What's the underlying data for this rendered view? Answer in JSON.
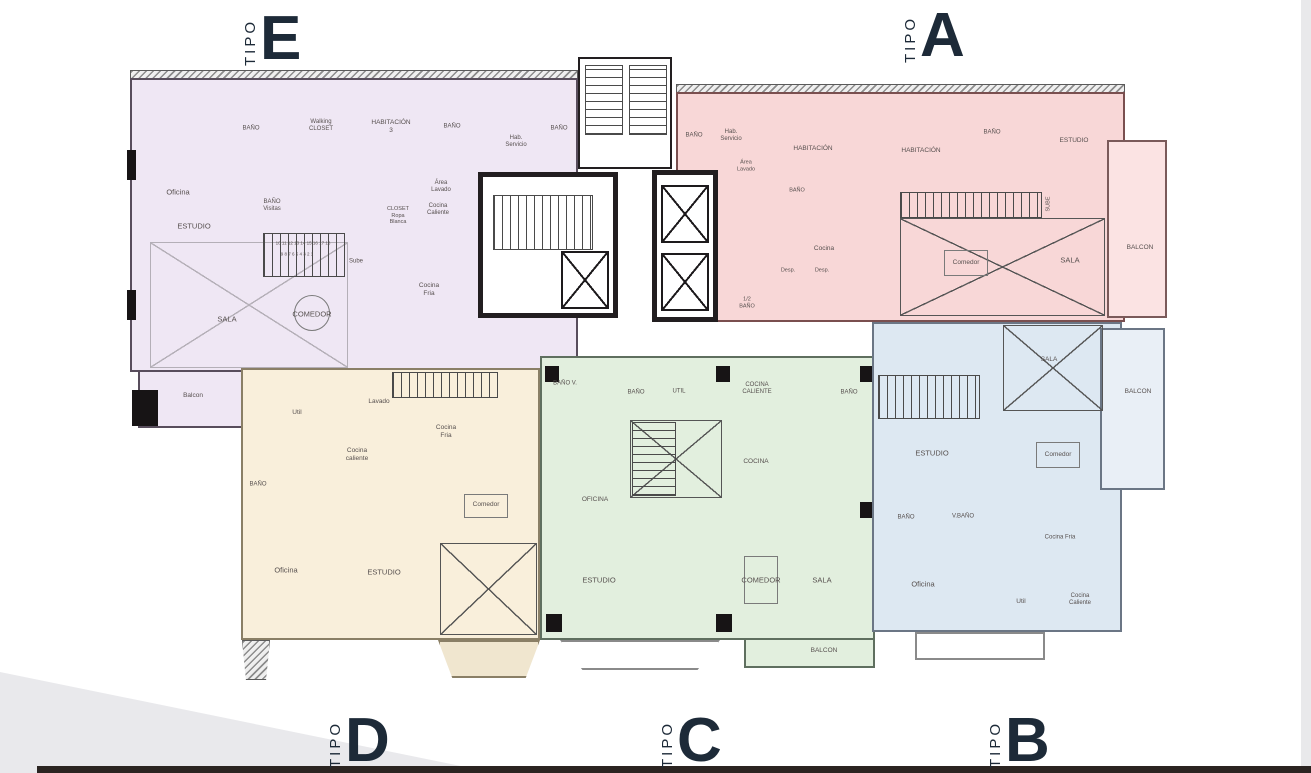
{
  "tipo_word": "TIPO",
  "colors": {
    "accent": "#1d2a38",
    "core_wall": "#221e20",
    "a_balcony": "#fbe3e3",
    "b_balcony": "#e9eff6",
    "d_balcony": "#f0e6cf",
    "corner_triangle": "#e9e9ec",
    "bottom_bar": "#2b2421",
    "right_strip": "#e9e9eb",
    "white": "#ffffff"
  },
  "units": [
    {
      "letter": "E",
      "fill": "#efe7f4",
      "wall": "#584d5c",
      "rooms": [
        {
          "t": "Oficina",
          "x": 178,
          "y": 192
        },
        {
          "t": "BAÑO",
          "x": 251,
          "y": 129,
          "s": 6
        },
        {
          "t": "Walking\nCLOSET",
          "x": 321,
          "y": 126,
          "s": 6
        },
        {
          "t": "HABITACIÓN\n3",
          "x": 391,
          "y": 127,
          "s": 6.5
        },
        {
          "t": "BAÑO",
          "x": 452,
          "y": 127,
          "s": 6
        },
        {
          "t": "Hab.\nServicio",
          "x": 516,
          "y": 142,
          "s": 6
        },
        {
          "t": "BAÑO",
          "x": 559,
          "y": 129,
          "s": 6
        },
        {
          "t": "BAÑO\nVisitas",
          "x": 272,
          "y": 206,
          "s": 6
        },
        {
          "t": "ESTUDIO",
          "x": 194,
          "y": 226
        },
        {
          "t": "CLOSET\nRopa\nBlanca",
          "x": 398,
          "y": 216,
          "s": 5.5
        },
        {
          "t": "Área\nLavado",
          "x": 441,
          "y": 187,
          "s": 6
        },
        {
          "t": "Cocina\nCaliente",
          "x": 438,
          "y": 210,
          "s": 6
        },
        {
          "t": "10 11 12 13 14 15 16 17 18",
          "x": 303,
          "y": 243,
          "s": 4.5
        },
        {
          "t": "9 8 7 6 5 4 3 2 1",
          "x": 297,
          "y": 254,
          "s": 4.5
        },
        {
          "t": "Sube",
          "x": 356,
          "y": 262,
          "s": 6
        },
        {
          "t": "Cocina\nFria",
          "x": 429,
          "y": 290,
          "s": 6.5
        },
        {
          "t": "SALA",
          "x": 227,
          "y": 319
        },
        {
          "t": "COMEDOR",
          "x": 312,
          "y": 314
        },
        {
          "t": "Balcon",
          "x": 193,
          "y": 396,
          "s": 6.5
        }
      ]
    },
    {
      "letter": "A",
      "fill": "#f8d7d7",
      "wall": "#7a4f4f",
      "rooms": [
        {
          "t": "BAÑO",
          "x": 694,
          "y": 136,
          "s": 6
        },
        {
          "t": "Hab.\nServicio",
          "x": 731,
          "y": 136,
          "s": 6
        },
        {
          "t": "Área\nLavado",
          "x": 746,
          "y": 166,
          "s": 5.5
        },
        {
          "t": "HABITACIÓN",
          "x": 813,
          "y": 149,
          "s": 6.5
        },
        {
          "t": "HABITACIÓN",
          "x": 921,
          "y": 151,
          "s": 6.5
        },
        {
          "t": "BAÑO",
          "x": 992,
          "y": 133,
          "s": 6
        },
        {
          "t": "ESTUDIO",
          "x": 1074,
          "y": 141,
          "s": 6.5
        },
        {
          "t": "BAÑO",
          "x": 797,
          "y": 191,
          "s": 5.5
        },
        {
          "t": "Cocina",
          "x": 824,
          "y": 249,
          "s": 6.5
        },
        {
          "t": "Desp.",
          "x": 788,
          "y": 271,
          "s": 5.5
        },
        {
          "t": "Desp.",
          "x": 822,
          "y": 271,
          "s": 5.5
        },
        {
          "t": "1/2\nBAÑO",
          "x": 747,
          "y": 303,
          "s": 5.5
        },
        {
          "t": "Comedor",
          "x": 966,
          "y": 263,
          "s": 6.5
        },
        {
          "t": "SALA",
          "x": 1070,
          "y": 260
        },
        {
          "t": "SUBE",
          "x": 1049,
          "y": 204,
          "s": 5.5,
          "v": true
        },
        {
          "t": "BALCON",
          "x": 1140,
          "y": 248,
          "s": 6.5
        }
      ]
    },
    {
      "letter": "D",
      "fill": "#f9efdb",
      "wall": "#8a7f66",
      "rooms": [
        {
          "t": "Util",
          "x": 297,
          "y": 413,
          "s": 6.5
        },
        {
          "t": "Lavado",
          "x": 379,
          "y": 402,
          "s": 6.5
        },
        {
          "t": "Cocina\nFria",
          "x": 446,
          "y": 432,
          "s": 6.5
        },
        {
          "t": "Cocina\ncaliente",
          "x": 357,
          "y": 455,
          "s": 6.5
        },
        {
          "t": "BAÑO",
          "x": 258,
          "y": 485,
          "s": 6
        },
        {
          "t": "Comedor",
          "x": 486,
          "y": 505,
          "s": 6.5
        },
        {
          "t": "Oficina",
          "x": 286,
          "y": 570
        },
        {
          "t": "ESTUDIO",
          "x": 384,
          "y": 572
        },
        {
          "t": "BAÑO V.",
          "x": 565,
          "y": 384,
          "s": 6
        }
      ]
    },
    {
      "letter": "C",
      "fill": "#e2efde",
      "wall": "#5f6f5f",
      "rooms": [
        {
          "t": "BAÑO",
          "x": 636,
          "y": 393,
          "s": 6
        },
        {
          "t": "UTIL",
          "x": 679,
          "y": 392,
          "s": 6
        },
        {
          "t": "COCINA\nCALIENTE",
          "x": 757,
          "y": 389,
          "s": 6
        },
        {
          "t": "BAÑO",
          "x": 849,
          "y": 393,
          "s": 6
        },
        {
          "t": "COCINA",
          "x": 756,
          "y": 462,
          "s": 6.5
        },
        {
          "t": "OFICINA",
          "x": 595,
          "y": 500,
          "s": 6.5
        },
        {
          "t": "ESTUDIO",
          "x": 599,
          "y": 580
        },
        {
          "t": "COMEDOR",
          "x": 761,
          "y": 580
        },
        {
          "t": "SALA",
          "x": 822,
          "y": 580
        },
        {
          "t": "BALCON",
          "x": 824,
          "y": 651,
          "s": 6.5
        }
      ]
    },
    {
      "letter": "B",
      "fill": "#dde8f2",
      "wall": "#6b7685",
      "rooms": [
        {
          "t": "SALA",
          "x": 1049,
          "y": 360,
          "s": 6.5
        },
        {
          "t": "BALCON",
          "x": 1138,
          "y": 392,
          "s": 6.5
        },
        {
          "t": "ESTUDIO",
          "x": 932,
          "y": 453
        },
        {
          "t": "Comedor",
          "x": 1058,
          "y": 455,
          "s": 6.5
        },
        {
          "t": "BAÑO",
          "x": 906,
          "y": 518,
          "s": 6
        },
        {
          "t": "V.BAÑO",
          "x": 963,
          "y": 517,
          "s": 6
        },
        {
          "t": "Cocina Fria",
          "x": 1060,
          "y": 538,
          "s": 6
        },
        {
          "t": "Oficina",
          "x": 923,
          "y": 584
        },
        {
          "t": "Util",
          "x": 1021,
          "y": 602,
          "s": 6.5
        },
        {
          "t": "Cocina\nCaliente",
          "x": 1080,
          "y": 600,
          "s": 6
        }
      ]
    }
  ]
}
